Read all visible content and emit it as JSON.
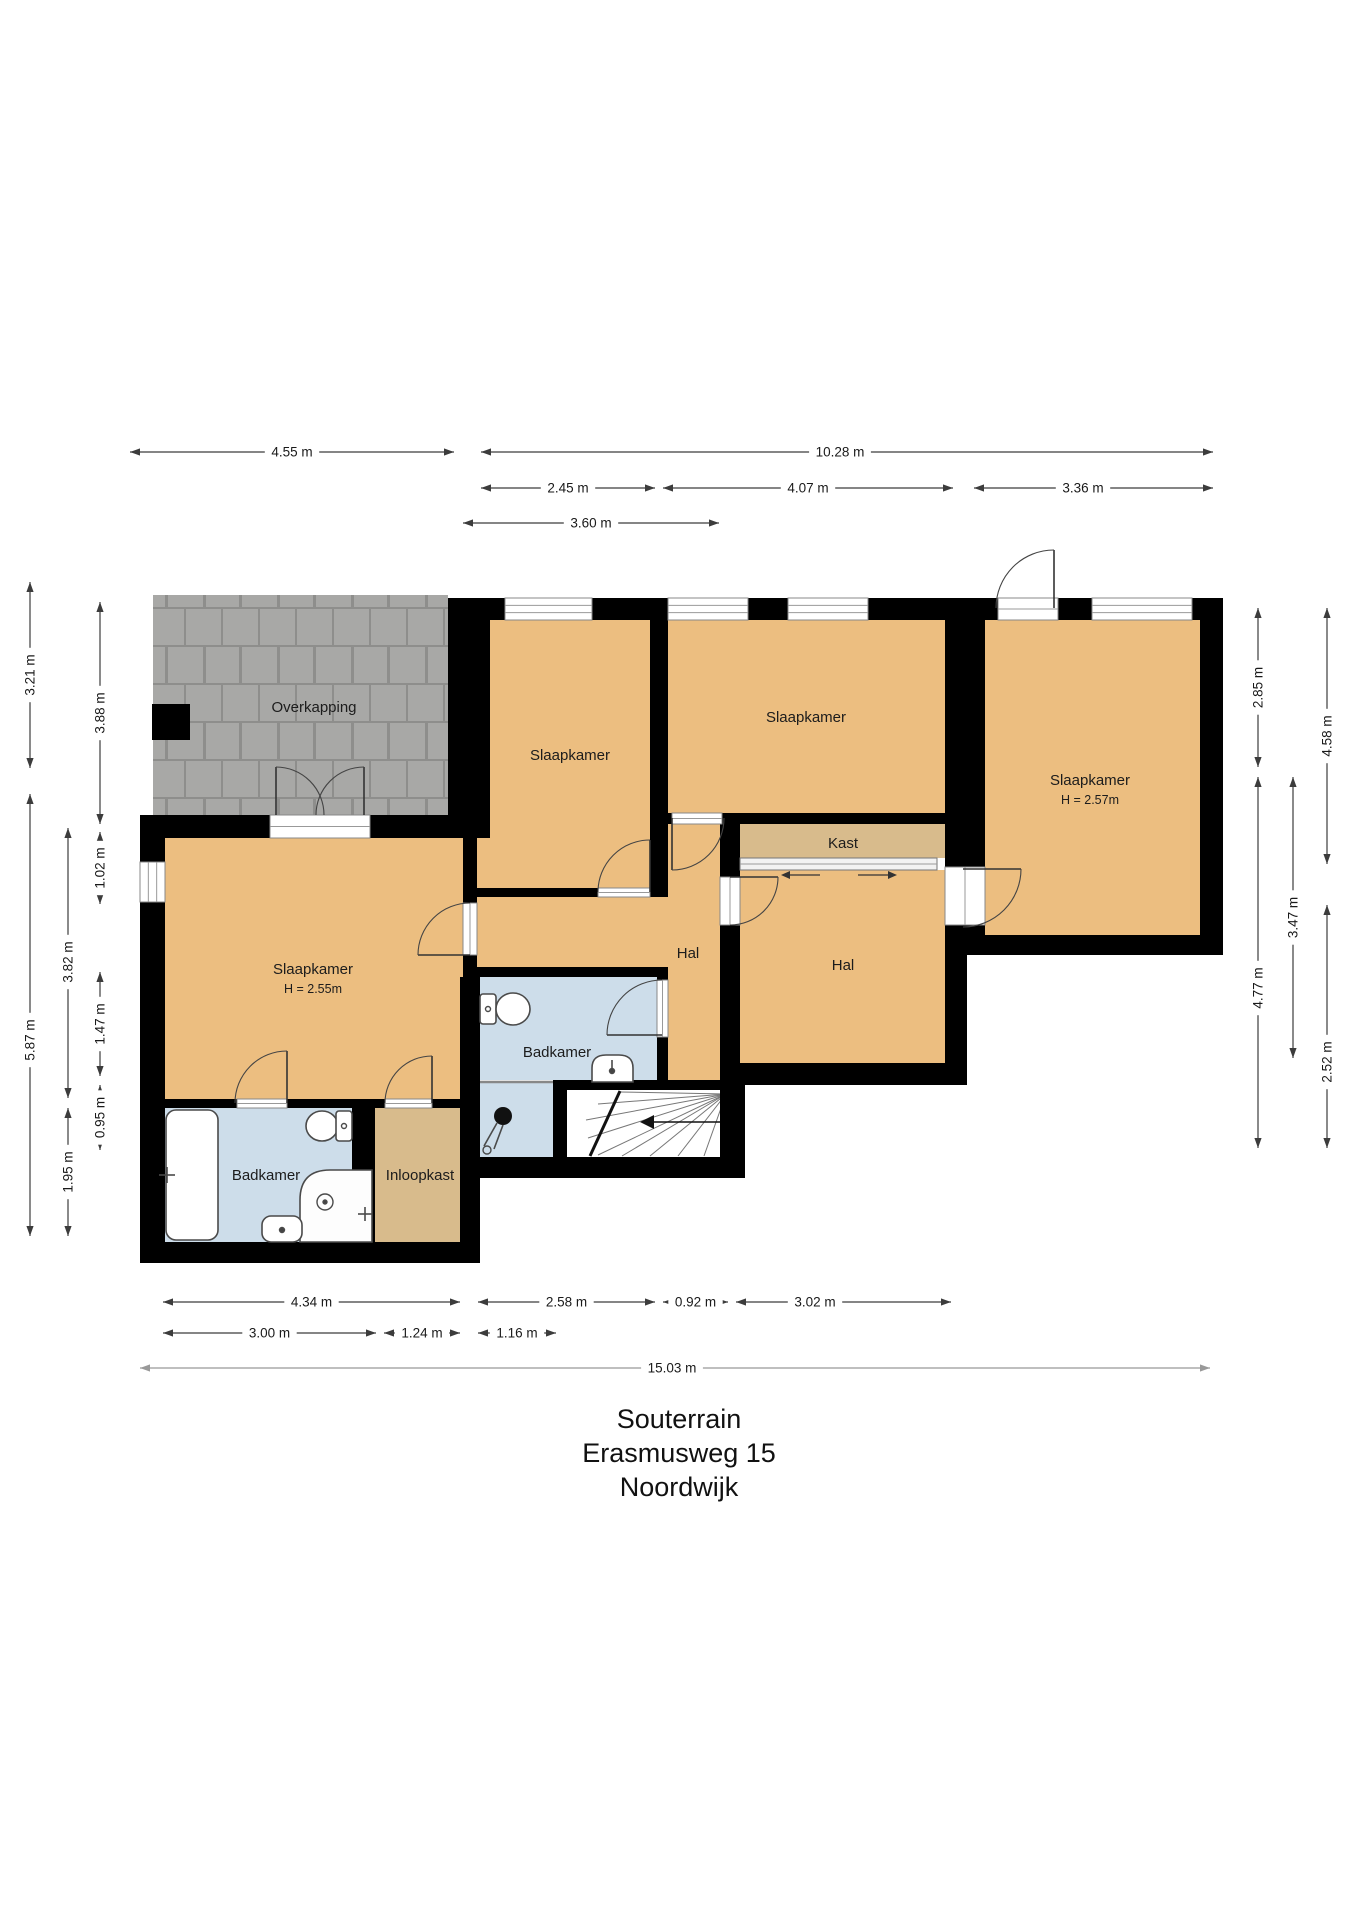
{
  "title": {
    "floor": "Souterrain",
    "street": "Erasmusweg 15",
    "city": "Noordwijk"
  },
  "colors": {
    "wall": "#000000",
    "room": "#ecbe80",
    "closet": "#d8bb8c",
    "bath": "#cdddea",
    "paver_base": "#8e8e8c",
    "paver_block": "#a8a8a6",
    "dim_line": "#3c3c3c",
    "dim_line_total": "#999999",
    "fixture_stroke": "#4a4a4a",
    "text": "#1c1c1c"
  },
  "plan": {
    "canvas": {
      "w": 1358,
      "h": 1920
    },
    "paver_area": {
      "name": "overkapping-pavers",
      "x": 153,
      "y": 595,
      "w": 295,
      "h": 220
    },
    "pillar": {
      "name": "pillar",
      "x": 152,
      "y": 704,
      "w": 38,
      "h": 36
    },
    "fills": [
      {
        "name": "room-slaapkamer-left",
        "color": "room",
        "x": 165,
        "y": 838,
        "w": 298,
        "h": 261
      },
      {
        "name": "room-slaapkamer-left-b",
        "color": "room",
        "x": 477,
        "y": 838,
        "w": 0,
        "h": 0
      },
      {
        "name": "room-slaapkamer-small",
        "color": "room",
        "x": 490,
        "y": 620,
        "w": 160,
        "h": 218
      },
      {
        "name": "room-slaapkamer-small-b",
        "color": "room",
        "x": 477,
        "y": 838,
        "w": 173,
        "h": 50
      },
      {
        "name": "room-slaapkamer-middle",
        "color": "room",
        "x": 668,
        "y": 620,
        "w": 277,
        "h": 193
      },
      {
        "name": "room-slaapkamer-right",
        "color": "room",
        "x": 985,
        "y": 620,
        "w": 215,
        "h": 315
      },
      {
        "name": "room-hal-left-a",
        "color": "room",
        "x": 477,
        "y": 897,
        "w": 191,
        "h": 70
      },
      {
        "name": "room-hal-left-b",
        "color": "room",
        "x": 668,
        "y": 824,
        "w": 52,
        "h": 256
      },
      {
        "name": "room-kast",
        "color": "closet",
        "x": 740,
        "y": 824,
        "w": 205,
        "h": 34
      },
      {
        "name": "room-hal-right",
        "color": "room",
        "x": 740,
        "y": 870,
        "w": 205,
        "h": 193
      },
      {
        "name": "room-badkamer-left",
        "color": "bath",
        "x": 165,
        "y": 1108,
        "w": 187,
        "h": 134
      },
      {
        "name": "room-inloopkast",
        "color": "closet",
        "x": 375,
        "y": 1108,
        "w": 85,
        "h": 134
      },
      {
        "name": "room-badkamer-middle",
        "color": "bath",
        "x": 480,
        "y": 977,
        "w": 177,
        "h": 103
      },
      {
        "name": "room-shower-area",
        "color": "bath",
        "x": 480,
        "y": 1083,
        "w": 73,
        "h": 74
      },
      {
        "name": "staircase-floor",
        "color": "#ffffff",
        "x": 567,
        "y": 1090,
        "w": 153,
        "h": 67
      }
    ],
    "walls": [
      [
        140,
        815,
        25,
        448
      ],
      [
        140,
        815,
        350,
        23
      ],
      [
        448,
        598,
        42,
        240
      ],
      [
        448,
        598,
        775,
        22
      ],
      [
        1200,
        598,
        23,
        357
      ],
      [
        967,
        935,
        256,
        20
      ],
      [
        945,
        620,
        40,
        315
      ],
      [
        945,
        935,
        22,
        150
      ],
      [
        720,
        1063,
        247,
        22
      ],
      [
        650,
        598,
        18,
        290
      ],
      [
        463,
        888,
        205,
        9
      ],
      [
        668,
        813,
        317,
        11
      ],
      [
        720,
        824,
        20,
        256
      ],
      [
        463,
        838,
        14,
        261
      ],
      [
        463,
        967,
        205,
        10
      ],
      [
        460,
        977,
        20,
        286
      ],
      [
        140,
        1099,
        340,
        9
      ],
      [
        352,
        1108,
        23,
        134
      ],
      [
        140,
        1242,
        340,
        21
      ],
      [
        657,
        977,
        11,
        103
      ],
      [
        553,
        1083,
        14,
        74
      ],
      [
        553,
        1080,
        192,
        10
      ],
      [
        460,
        1157,
        285,
        21
      ],
      [
        720,
        1080,
        25,
        98
      ]
    ],
    "windows": [
      {
        "name": "window",
        "x": 505,
        "y": 598,
        "w": 87,
        "h": 22,
        "dir": "h"
      },
      {
        "name": "window",
        "x": 668,
        "y": 598,
        "w": 80,
        "h": 22,
        "dir": "h"
      },
      {
        "name": "window",
        "x": 788,
        "y": 598,
        "w": 80,
        "h": 22,
        "dir": "h"
      },
      {
        "name": "window",
        "x": 1092,
        "y": 598,
        "w": 100,
        "h": 22,
        "dir": "h"
      },
      {
        "name": "window",
        "x": 140,
        "y": 862,
        "w": 25,
        "h": 40,
        "dir": "v"
      }
    ],
    "door_sills": [
      {
        "x": 998,
        "y": 598,
        "w": 60,
        "h": 22,
        "dir": "h"
      },
      {
        "x": 270,
        "y": 815,
        "w": 100,
        "h": 23,
        "dir": "h"
      },
      {
        "x": 463,
        "y": 903,
        "w": 14,
        "h": 52,
        "dir": "v"
      },
      {
        "x": 598,
        "y": 888,
        "w": 52,
        "h": 9,
        "dir": "h"
      },
      {
        "x": 672,
        "y": 813,
        "w": 50,
        "h": 11,
        "dir": "h"
      },
      {
        "x": 720,
        "y": 877,
        "w": 20,
        "h": 48,
        "dir": "v"
      },
      {
        "x": 945,
        "y": 867,
        "w": 40,
        "h": 58,
        "dir": "v"
      },
      {
        "x": 657,
        "y": 980,
        "w": 11,
        "h": 57,
        "dir": "v"
      },
      {
        "x": 237,
        "y": 1099,
        "w": 50,
        "h": 9,
        "dir": "h"
      },
      {
        "x": 385,
        "y": 1099,
        "w": 47,
        "h": 9,
        "dir": "h"
      }
    ],
    "doors": [
      {
        "hinge": [
          276,
          815
        ],
        "start": [
          276,
          767
        ],
        "end": [
          324,
          815
        ]
      },
      {
        "hinge": [
          364,
          815
        ],
        "start": [
          364,
          767
        ],
        "end": [
          316,
          815
        ]
      },
      {
        "hinge": [
          470,
          955
        ],
        "start": [
          418,
          955
        ],
        "end": [
          470,
          903
        ]
      },
      {
        "hinge": [
          650,
          892
        ],
        "start": [
          650,
          840
        ],
        "end": [
          598,
          892
        ]
      },
      {
        "hinge": [
          672,
          818
        ],
        "start": [
          672,
          870
        ],
        "end": [
          724,
          818
        ]
      },
      {
        "hinge": [
          730,
          877
        ],
        "start": [
          778,
          877
        ],
        "end": [
          730,
          925
        ]
      },
      {
        "hinge": [
          963,
          869
        ],
        "start": [
          1021,
          869
        ],
        "end": [
          963,
          927
        ]
      },
      {
        "hinge": [
          662,
          1035
        ],
        "start": [
          607,
          1035
        ],
        "end": [
          662,
          980
        ]
      },
      {
        "hinge": [
          287,
          1103
        ],
        "start": [
          287,
          1051
        ],
        "end": [
          235,
          1103
        ]
      },
      {
        "hinge": [
          432,
          1103
        ],
        "start": [
          432,
          1056
        ],
        "end": [
          385,
          1103
        ]
      },
      {
        "hinge": [
          1054,
          608
        ],
        "start": [
          1054,
          550
        ],
        "end": [
          996,
          608
        ]
      }
    ],
    "slider": {
      "track": {
        "x": 740,
        "y": 858,
        "w": 197,
        "h": 12
      },
      "arrows": [
        {
          "x1": 820,
          "x2": 790,
          "y": 875,
          "head": "left"
        },
        {
          "x1": 858,
          "x2": 888,
          "y": 875,
          "head": "right"
        }
      ]
    },
    "stairs": {
      "rays": [
        [
          726,
          1094,
          620,
          1092
        ],
        [
          726,
          1094,
          598,
          1104
        ],
        [
          726,
          1094,
          586,
          1120
        ],
        [
          726,
          1094,
          588,
          1138
        ],
        [
          726,
          1094,
          598,
          1155
        ],
        [
          726,
          1094,
          622,
          1156
        ],
        [
          726,
          1094,
          650,
          1156
        ],
        [
          726,
          1094,
          678,
          1156
        ],
        [
          726,
          1094,
          704,
          1156
        ]
      ],
      "winder_edge": [
        620,
        1091,
        590,
        1156
      ],
      "arrow_line": [
        648,
        1122,
        724,
        1122
      ],
      "arrow_head": [
        640,
        1122
      ]
    },
    "partitions": [
      [
        480,
        1082,
        553,
        1082
      ]
    ],
    "fixtures": [
      {
        "t": "rect",
        "name": "bathtub",
        "x": 166,
        "y": 1110,
        "w": 52,
        "h": 130,
        "rx": 10,
        "f": "#ffffff"
      },
      {
        "t": "line",
        "name": "bathtub-tap",
        "pts": [
          159,
          1175,
          175,
          1175
        ]
      },
      {
        "t": "line",
        "name": "bathtub-tap",
        "pts": [
          167,
          1167,
          167,
          1183
        ]
      },
      {
        "t": "ellipse",
        "name": "toilet-bowl",
        "cx": 322,
        "cy": 1126,
        "rx": 16,
        "ry": 15,
        "f": "#ffffff"
      },
      {
        "t": "rect",
        "name": "toilet-cistern",
        "x": 336,
        "y": 1111,
        "w": 16,
        "h": 30,
        "rx": 3,
        "f": "#ffffff"
      },
      {
        "t": "circle",
        "name": "toilet-button",
        "cx": 344,
        "cy": 1126,
        "r": 2.5,
        "f": "#ffffff"
      },
      {
        "t": "path",
        "name": "shower-tray",
        "d": "M300,1242 L300,1200 Q300,1170 330,1170 L372,1170 L372,1242 Z",
        "f": "#fdfdfd"
      },
      {
        "t": "circle",
        "name": "shower-drain",
        "cx": 325,
        "cy": 1202,
        "r": 8,
        "f": "none"
      },
      {
        "t": "circle",
        "name": "shower-drain",
        "cx": 325,
        "cy": 1202,
        "r": 2,
        "f": "#444444"
      },
      {
        "t": "line",
        "name": "shower-tap",
        "pts": [
          358,
          1214,
          372,
          1214
        ]
      },
      {
        "t": "line",
        "name": "shower-tap",
        "pts": [
          365,
          1207,
          365,
          1221
        ]
      },
      {
        "t": "rect",
        "name": "sink",
        "x": 262,
        "y": 1216,
        "w": 40,
        "h": 26,
        "rx": 9,
        "f": "#ffffff"
      },
      {
        "t": "circle",
        "name": "sink-drain",
        "cx": 282,
        "cy": 1230,
        "r": 2.5,
        "f": "#444444"
      },
      {
        "t": "rect",
        "name": "toilet-cistern",
        "x": 480,
        "y": 994,
        "w": 16,
        "h": 30,
        "rx": 3,
        "f": "#ffffff"
      },
      {
        "t": "ellipse",
        "name": "toilet-bowl",
        "cx": 513,
        "cy": 1009,
        "rx": 17,
        "ry": 16,
        "f": "#ffffff"
      },
      {
        "t": "circle",
        "name": "toilet-button",
        "cx": 488,
        "cy": 1009,
        "r": 2.5,
        "f": "#ffffff"
      },
      {
        "t": "path",
        "name": "sink",
        "d": "M592,1082 L592,1068 Q592,1055 606,1055 L619,1055 Q633,1055 633,1068 L633,1082 Z",
        "f": "#ffffff"
      },
      {
        "t": "circle",
        "name": "sink-drain",
        "cx": 612,
        "cy": 1071,
        "r": 2.5,
        "f": "#444444"
      },
      {
        "t": "line",
        "name": "sink-tap",
        "pts": [
          612,
          1060,
          612,
          1068
        ]
      },
      {
        "t": "circle",
        "name": "shower-head",
        "cx": 503,
        "cy": 1116,
        "r": 9,
        "f": "#111111"
      },
      {
        "t": "line",
        "name": "shower-hose",
        "pts": [
          497,
          1123,
          484,
          1146
        ]
      },
      {
        "t": "line",
        "name": "shower-hose",
        "pts": [
          503,
          1125,
          494,
          1149
        ]
      },
      {
        "t": "circle",
        "name": "shower-foot",
        "cx": 487,
        "cy": 1150,
        "r": 4,
        "f": "none"
      }
    ],
    "room_labels": [
      {
        "text": "Overkapping",
        "x": 314,
        "y": 712
      },
      {
        "text": "Slaapkamer",
        "x": 570,
        "y": 760
      },
      {
        "text": "Slaapkamer",
        "x": 806,
        "y": 722
      },
      {
        "text": "Slaapkamer",
        "x": 1090,
        "y": 785,
        "sub": "H = 2.57m",
        "sub_y": 804
      },
      {
        "text": "Slaapkamer",
        "x": 313,
        "y": 974,
        "sub": "H = 2.55m",
        "sub_y": 993
      },
      {
        "text": "Kast",
        "x": 843,
        "y": 848
      },
      {
        "text": "Hal",
        "x": 688,
        "y": 958
      },
      {
        "text": "Hal",
        "x": 843,
        "y": 970
      },
      {
        "text": "Badkamer",
        "x": 266,
        "y": 1180
      },
      {
        "text": "Inloopkast",
        "x": 420,
        "y": 1180
      },
      {
        "text": "Badkamer",
        "x": 557,
        "y": 1057
      }
    ],
    "dimensions": [
      {
        "label": "4.55 m",
        "orient": "h",
        "pos": 452,
        "a": 130,
        "b": 454
      },
      {
        "label": "10.28 m",
        "orient": "h",
        "pos": 452,
        "a": 481,
        "b": 1213,
        "lc": 840
      },
      {
        "label": "2.45 m",
        "orient": "h",
        "pos": 488,
        "a": 481,
        "b": 655
      },
      {
        "label": "4.07 m",
        "orient": "h",
        "pos": 488,
        "a": 663,
        "b": 953
      },
      {
        "label": "3.36 m",
        "orient": "h",
        "pos": 488,
        "a": 974,
        "b": 1213,
        "lc": 1083
      },
      {
        "label": "3.60 m",
        "orient": "h",
        "pos": 523,
        "a": 463,
        "b": 719
      },
      {
        "label": "3.21 m",
        "orient": "v",
        "pos": 30,
        "a": 582,
        "b": 768
      },
      {
        "label": "5.87 m",
        "orient": "v",
        "pos": 30,
        "a": 794,
        "b": 1236,
        "lc": 1040
      },
      {
        "label": "3.82 m",
        "orient": "v",
        "pos": 68,
        "a": 828,
        "b": 1098,
        "lc": 962
      },
      {
        "label": "1.95 m",
        "orient": "v",
        "pos": 68,
        "a": 1108,
        "b": 1236,
        "lc": 1172
      },
      {
        "label": "3.88 m",
        "orient": "v",
        "pos": 100,
        "a": 602,
        "b": 824
      },
      {
        "label": "1.02 m",
        "orient": "v",
        "pos": 100,
        "a": 832,
        "b": 904
      },
      {
        "label": "1.47 m",
        "orient": "v",
        "pos": 100,
        "a": 972,
        "b": 1076
      },
      {
        "label": "0.95 m",
        "orient": "v",
        "pos": 100,
        "a": 1085,
        "b": 1150
      },
      {
        "label": "2.85 m",
        "orient": "v",
        "pos": 1258,
        "a": 608,
        "b": 767
      },
      {
        "label": "4.77 m",
        "orient": "v",
        "pos": 1258,
        "a": 777,
        "b": 1148,
        "lc": 988
      },
      {
        "label": "3.47 m",
        "orient": "v",
        "pos": 1293,
        "a": 777,
        "b": 1058
      },
      {
        "label": "4.58 m",
        "orient": "v",
        "pos": 1327,
        "a": 608,
        "b": 864
      },
      {
        "label": "2.52 m",
        "orient": "v",
        "pos": 1327,
        "a": 905,
        "b": 1148,
        "lc": 1062
      },
      {
        "label": "4.34 m",
        "orient": "h",
        "pos": 1302,
        "a": 163,
        "b": 460
      },
      {
        "label": "2.58 m",
        "orient": "h",
        "pos": 1302,
        "a": 478,
        "b": 655
      },
      {
        "label": "0.92 m",
        "orient": "h",
        "pos": 1302,
        "a": 663,
        "b": 728
      },
      {
        "label": "3.02 m",
        "orient": "h",
        "pos": 1302,
        "a": 736,
        "b": 951,
        "lc": 815
      },
      {
        "label": "3.00 m",
        "orient": "h",
        "pos": 1333,
        "a": 163,
        "b": 376
      },
      {
        "label": "1.24 m",
        "orient": "h",
        "pos": 1333,
        "a": 384,
        "b": 460
      },
      {
        "label": "1.16 m",
        "orient": "h",
        "pos": 1333,
        "a": 478,
        "b": 556
      },
      {
        "label": "15.03 m",
        "orient": "h",
        "pos": 1368,
        "a": 140,
        "b": 1210,
        "lc": 672,
        "total": true
      }
    ]
  }
}
